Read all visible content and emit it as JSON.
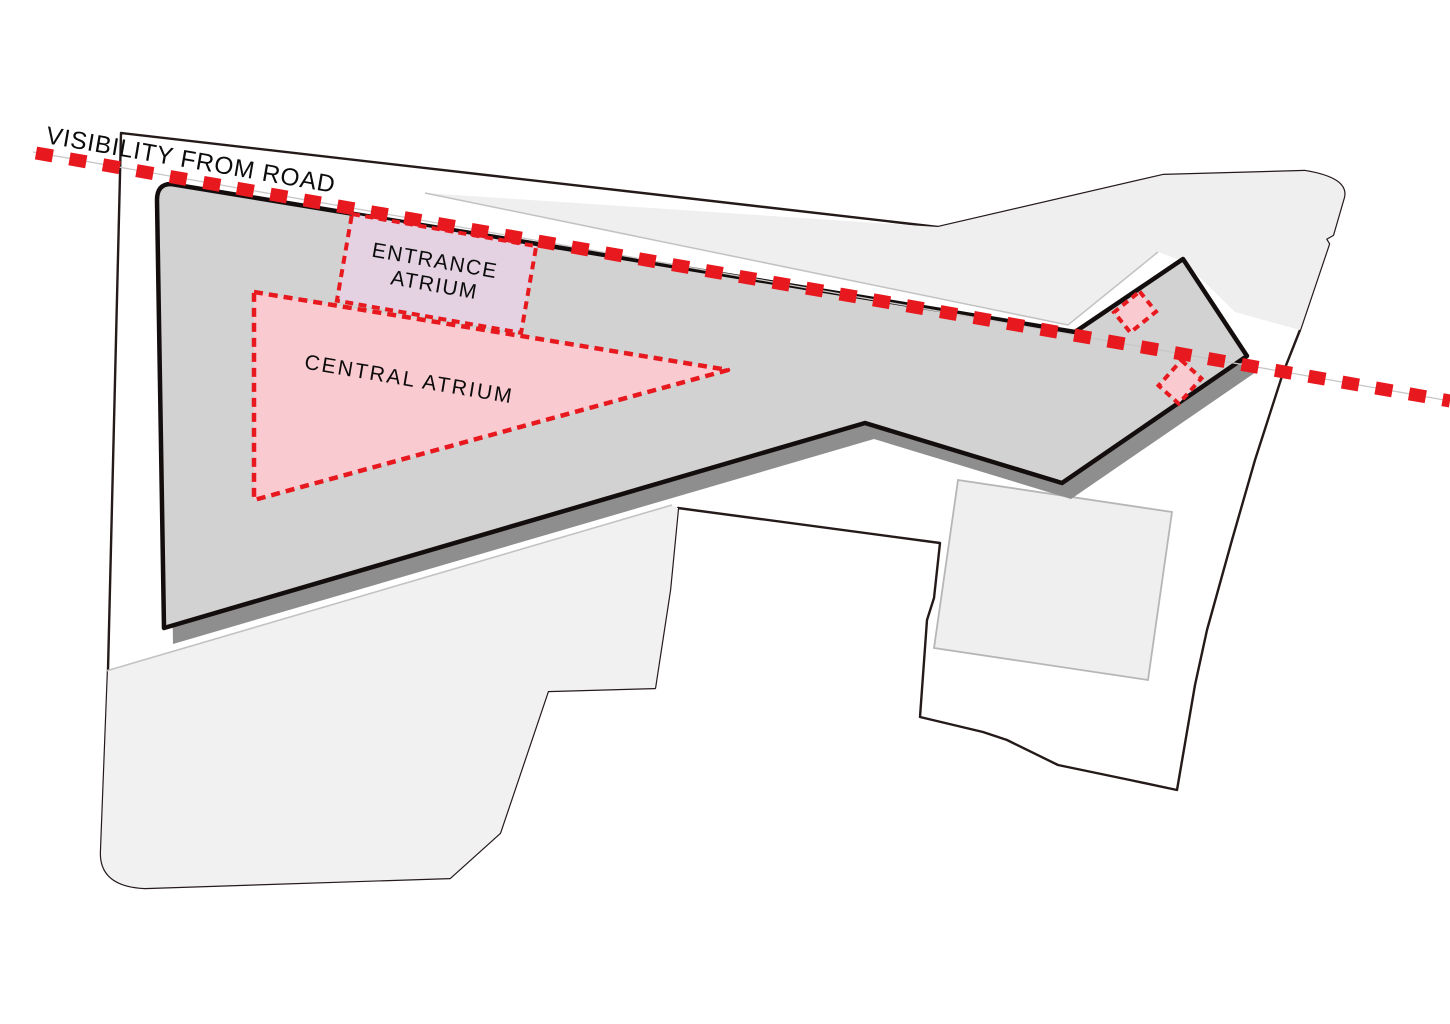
{
  "diagram_title": "Site massing diagram with visibility sightline and atrium zones",
  "canvas": {
    "width": 1450,
    "height": 1024
  },
  "zones": {
    "sightline": {
      "label": "VISIBILITY FROM ROAD",
      "color": "#e7191f"
    },
    "entrance_atrium": {
      "label_lines": [
        "ENTRANCE",
        "ATRIUM"
      ],
      "fill": "#e4d2e2",
      "border": "#e7191f"
    },
    "central_atrium": {
      "label": "CENTRAL ATRIUM",
      "fill": "#f9cad0",
      "border": "#e7191f"
    },
    "skylight_squares": {
      "count": 2,
      "fill": "#f9cad0",
      "border": "#e7191f"
    }
  },
  "colors": {
    "background": "#ffffff",
    "building_fill": "#d2d2d2",
    "building_outline": "#140d0d",
    "building_shadow": "#8e8e8e",
    "site_fill": "#ffffff",
    "site_outline": "#241a1a",
    "parcel_fill": "#efefef",
    "parcel_fill_sw": "#f1f1f1",
    "parcel_outline": "#b8b5b5",
    "faint_line": "#c4c1c1",
    "road_line": "#c9c6c6",
    "dashed_red": "#e7191f",
    "text": "#0c0c0c"
  }
}
